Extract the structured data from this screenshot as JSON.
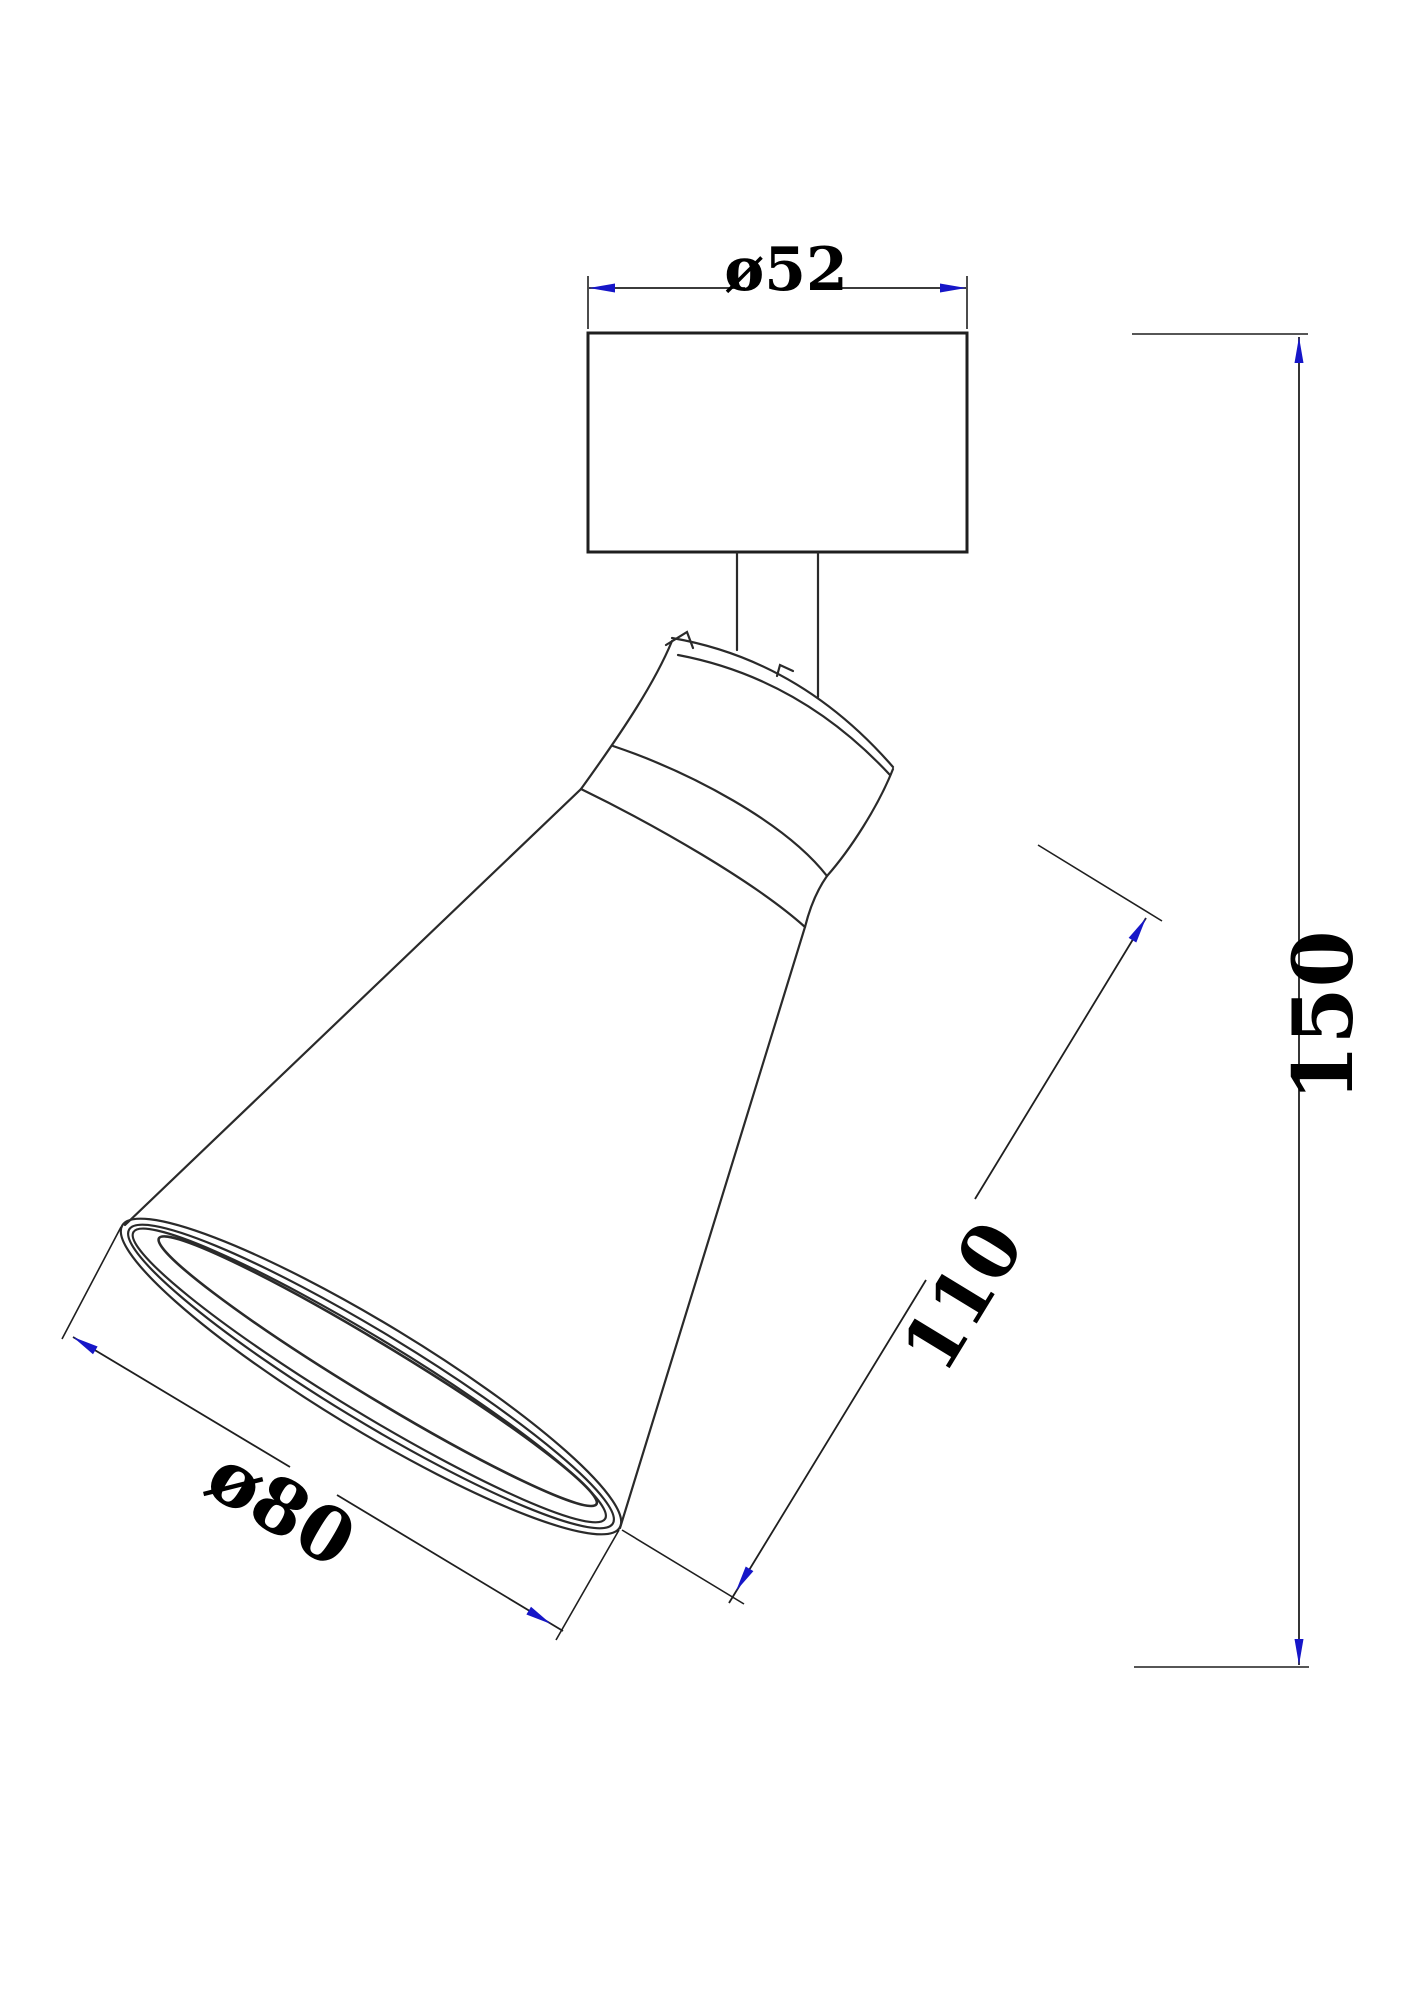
{
  "drawing": {
    "type": "technical-dimension-drawing",
    "subject": "adjustable spot light fixture, side elevation with ceiling canopy and tilted cone shade",
    "background_color": "#ffffff",
    "line_color": "#2a2a2a",
    "arrow_color": "#1616c8",
    "text_color": "#000000",
    "units": "mm",
    "dimensions": [
      {
        "id": "dia52",
        "label": "ø52",
        "value": 52,
        "kind": "diameter",
        "part": "canopy width"
      },
      {
        "id": "h150",
        "label": "150",
        "value": 150,
        "kind": "linear",
        "part": "overall height"
      },
      {
        "id": "l110",
        "label": "110",
        "value": 110,
        "kind": "linear",
        "part": "shade length"
      },
      {
        "id": "dia80",
        "label": "ø80",
        "value": 80,
        "kind": "diameter",
        "part": "shade opening"
      }
    ]
  }
}
